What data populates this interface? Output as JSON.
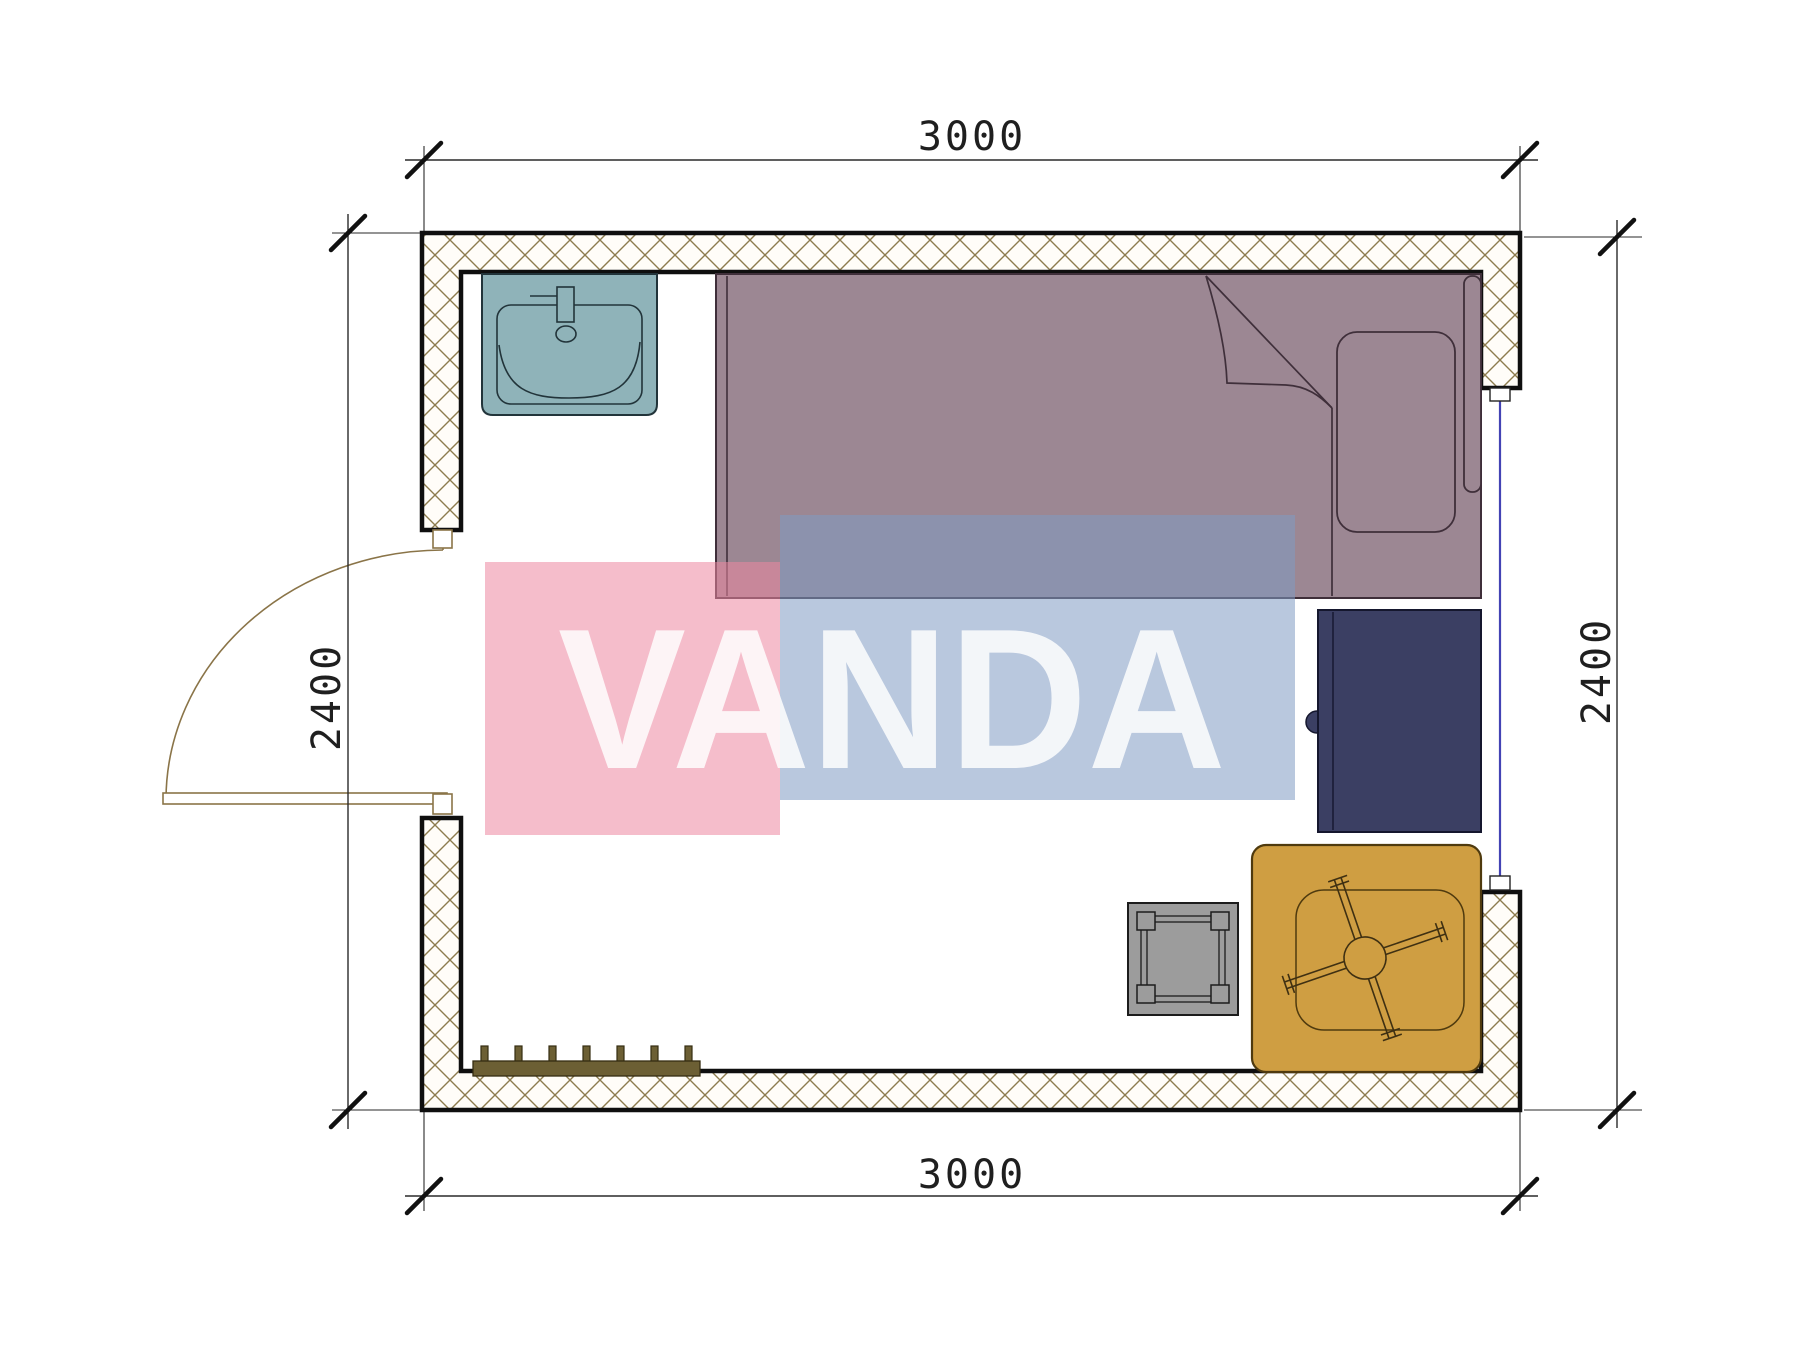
{
  "page": {
    "type": "architectural-floor-plan",
    "room_width_mm": 3000,
    "room_height_mm": 2400
  },
  "dimensions": {
    "top": "3000",
    "bottom": "3000",
    "left": "2400",
    "right": "2400"
  },
  "watermark": {
    "text": "VANDA",
    "pink_color": "#ec87a0",
    "blue_color": "#809bc3",
    "text_color": "#ffffff"
  },
  "colors": {
    "wall_outline": "#0f0f0f",
    "wall_hatch": "#8d7c4e",
    "door": "#8a7448",
    "window_glass": "#4343b4",
    "dimension_lines": "#2a2a2a",
    "sink": "#8fb3b9",
    "bed": "#9c8793",
    "bed_outline": "#3f2f3a",
    "desk": "#3b3f63",
    "table": "#cf9e42",
    "table_outline": "#4f3a0e",
    "stool": "#9c9c9c",
    "coat_rack": "#6c5f34"
  },
  "furniture": [
    {
      "name": "sink"
    },
    {
      "name": "single-bed"
    },
    {
      "name": "desk"
    },
    {
      "name": "table-with-chair"
    },
    {
      "name": "stool"
    },
    {
      "name": "coat-rack"
    }
  ]
}
